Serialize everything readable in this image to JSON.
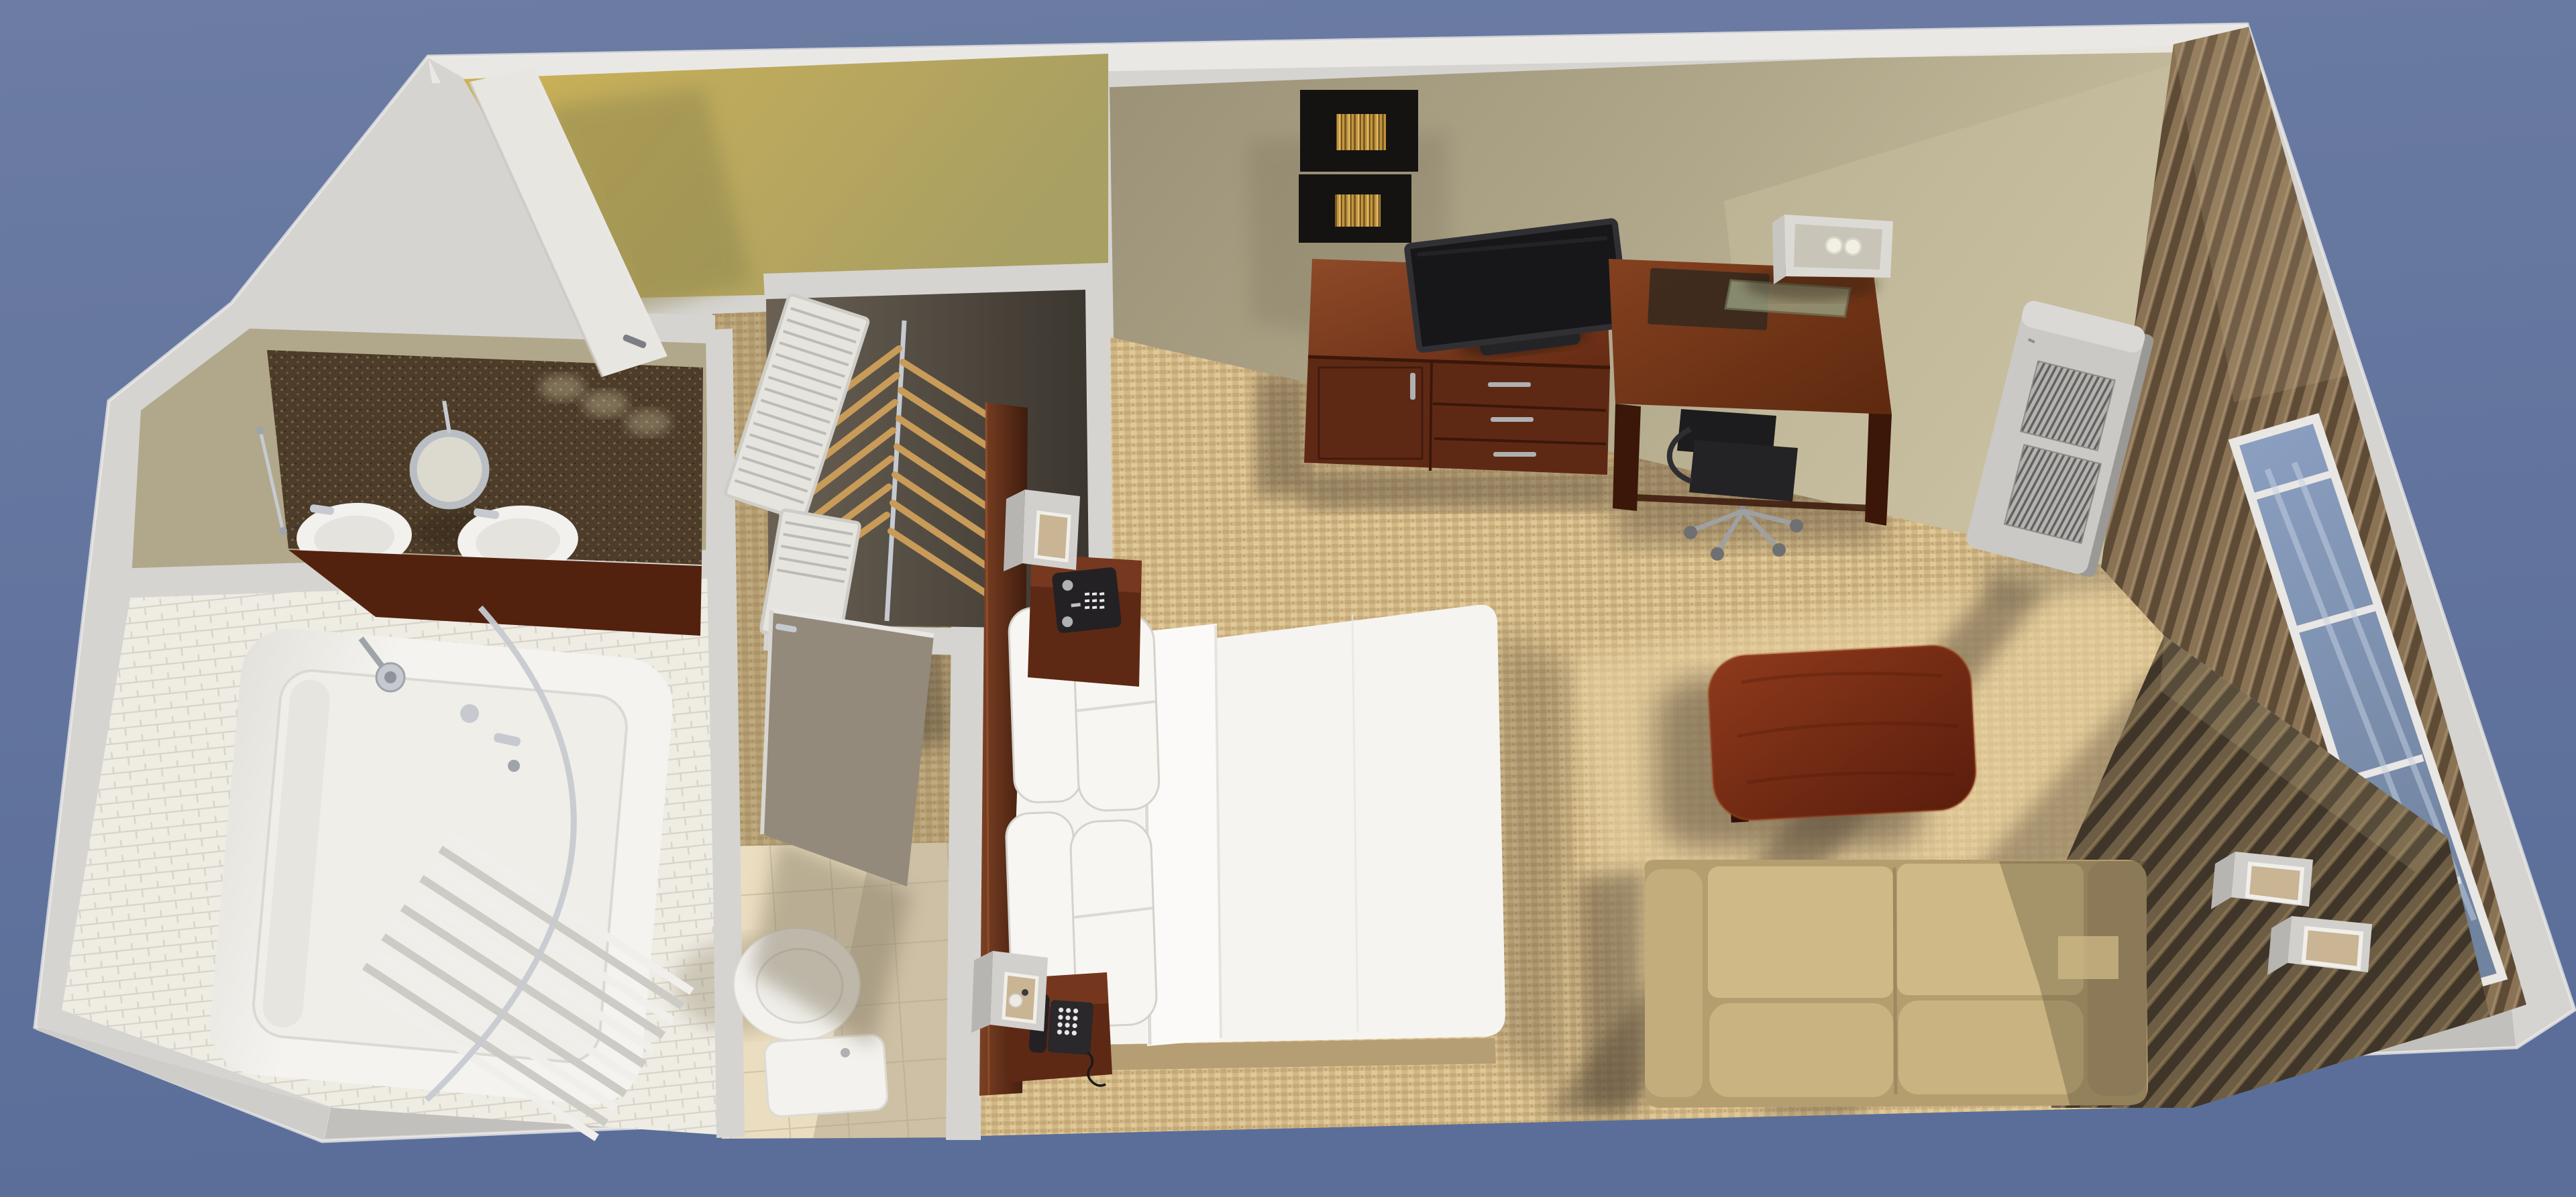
{
  "meta": {
    "title": "3D cutaway rendering of a hotel studio guest room, top-down view",
    "render_style": "photoreal 3D floor-plan cutaway",
    "visible_text": []
  },
  "colors": {
    "bg-top": "#6C7CA3",
    "bg-bottom": "#5A6E99",
    "wall-cap": "#D6D4D1",
    "wall-cap-bright": "#ECEAE7",
    "wall-band-dark": "#C2C0BD",
    "wall-face-lit": "#C9C0A1",
    "wall-face": "#B1A88B",
    "wall-face-dark": "#9A9177",
    "carpet-base": "#D3B885",
    "carpet-lit": "#E8D2A2",
    "carpet-speck-dark": "#B3986B",
    "carpet-speck-light": "#EFDFB2",
    "shadow-warm": "#5C4E3A",
    "entry-lit": "#CDB257",
    "entry-dark": "#A89F63",
    "vinyl-shadow": "#8F874F",
    "closet-dark": "#3B362F",
    "closet-light": "#6A6154",
    "hanger-wood": "#C89B59",
    "chrome": "#C6CAD0",
    "chrome-dark": "#9FA4AA",
    "louver": "#E6E4DF",
    "louver-slat": "#BDBBB6",
    "counter-dark": "#4C3C29",
    "counter-speck": "#7C6848",
    "sink-white": "#F2F1ED",
    "cabinet-wood": "#52220F",
    "mirror-ring": "#B9BEC4",
    "mirror-glass": "#DCD9CE",
    "tile-wall": "#EFECE4",
    "tile-grout": "#D8D4C9",
    "tub-white": "#F4F3EF",
    "tub-shade": "#DBD9D3",
    "curtain-light": "#F0EFEB",
    "curtain-shade": "#CDCBC6",
    "toilet-white": "#F3F2EE",
    "bathfloor": "#EADDC0",
    "bathfloor-grout": "#CFC4A8",
    "door-white": "#E8E6E1",
    "door-shadowed": "#938A7B",
    "wood-lit": "#8A4526",
    "wood-mid": "#5E2914",
    "wood-dark": "#3A1709",
    "cherry-lit": "#8E3A1C",
    "cherry-dark": "#5A1D0C",
    "bed-white": "#F6F4F0",
    "bed-fold": "#FBFAF8",
    "bed-crease": "#D5D2CC",
    "bed-base": "#B59E74",
    "pillow-white": "#F8F6F2",
    "tv-black": "#17171A",
    "tv-bezel": "#303034",
    "device-black": "#242124",
    "silver": "#AFB1B3",
    "sofa-base": "#B49E70",
    "sofa-back": "#CFBA87",
    "sofa-seat": "#C9B380",
    "sofa-arm": "#C3AD7C",
    "sofa-arm-dark": "#A8926A",
    "sconce-face": "#D2D0CC",
    "sconce-side": "#B7B5B1",
    "sconce-glow": "#C9B494",
    "sconce-rim": "#F0EFEA",
    "ac-body": "#CBC9C6",
    "ac-shade": "#9B9996",
    "ac-vent": "#636260",
    "ac-vent-bg": "#B5B3B0",
    "blind-light": "#8A7355",
    "blind-dark": "#5E4B36",
    "blind-hi": "#A0896A",
    "slat-light": "#6E5D45",
    "slat-dark": "#3F3528",
    "glass-blue": "#7E92B5",
    "glass-hi": "#C6D2E2",
    "frame-white": "#E9E7E4",
    "art-black": "#141311",
    "art-gold": "#C2953C",
    "art-gold-dark": "#7A5A24",
    "art-gold-hi": "#E0B968",
    "lamp-white": "#DCDAD5",
    "lamp-inner": "#C9C4B8",
    "bulb": "#F2EFE4",
    "glasspad": "#9AA183",
    "deskpad": "#3A2A1E"
  },
  "scene": {
    "rooms": [
      {
        "name": "entry-vestibule",
        "floor": "yellow vinyl",
        "items": [
          "entry-door-open"
        ]
      },
      {
        "name": "vanity-area",
        "items": [
          "granite-counter",
          "double-sinks",
          "magnifying-mirror",
          "towel-bar",
          "vanity-cabinet"
        ]
      },
      {
        "name": "shower-room",
        "floor": "white subway tile",
        "items": [
          "bathtub",
          "shower-curtain",
          "curved-curtain-rod",
          "showerhead",
          "tub-faucet"
        ]
      },
      {
        "name": "toilet-nook",
        "floor": "beige ceramic tile",
        "items": [
          "toilet",
          "bathroom-door-open"
        ]
      },
      {
        "name": "closet",
        "items": [
          "louvered-doors-open",
          "clothes-rod",
          "wooden-hangers"
        ]
      },
      {
        "name": "main-room",
        "floor": "beige loop carpet",
        "items": [
          "bed",
          "pillows",
          "headboard",
          "nightstand-with-clock",
          "nightstand-with-phone",
          "wall-sconces",
          "dresser",
          "flat-screen-tv",
          "wall-art-pair",
          "work-desk",
          "desk-lamp",
          "office-chair",
          "ptac-ac-unit",
          "coffee-table",
          "loveseat-sofa",
          "wood-slat-accent-wall",
          "cube-wall-lamps",
          "window-wall-with-blinds"
        ]
      }
    ],
    "objects": [
      {
        "name": "entry-door",
        "state": "open",
        "color": "door-white"
      },
      {
        "name": "bathroom-door",
        "state": "open",
        "color": "door-shadowed"
      },
      {
        "name": "louvered-closet-doors",
        "count": 2,
        "color": "louver"
      },
      {
        "name": "wooden-hangers",
        "count": 14,
        "color": "hanger-wood"
      },
      {
        "name": "double-sink-counter",
        "color": "counter-dark"
      },
      {
        "name": "round-magnifying-mirror",
        "color": "mirror-ring"
      },
      {
        "name": "bathtub",
        "color": "tub-white"
      },
      {
        "name": "shower-curtain",
        "color": "curtain-light"
      },
      {
        "name": "toilet",
        "color": "toilet-white"
      },
      {
        "name": "king-bed-white-bedding",
        "color": "bed-white"
      },
      {
        "name": "pillows",
        "count": 4,
        "color": "pillow-white"
      },
      {
        "name": "headboard",
        "color": "wood-mid"
      },
      {
        "name": "nightstand",
        "count": 2,
        "color": "wood-mid"
      },
      {
        "name": "alarm-clock-radio",
        "color": "device-black"
      },
      {
        "name": "telephone",
        "color": "device-black"
      },
      {
        "name": "bedside-sconce",
        "count": 2,
        "color": "sconce-face"
      },
      {
        "name": "dresser-credenza",
        "color": "wood-mid"
      },
      {
        "name": "flat-screen-tv",
        "color": "tv-black"
      },
      {
        "name": "framed-art",
        "count": 2,
        "color": "art-black"
      },
      {
        "name": "writing-desk",
        "color": "wood-mid"
      },
      {
        "name": "desk-lamp-open-shade",
        "color": "lamp-white"
      },
      {
        "name": "office-chair",
        "color": "device-black"
      },
      {
        "name": "ptac-air-conditioner",
        "color": "ac-body"
      },
      {
        "name": "coffee-table",
        "color": "cherry-lit"
      },
      {
        "name": "loveseat",
        "color": "sofa-base"
      },
      {
        "name": "cube-wall-lamp",
        "count": 2,
        "color": "sconce-face"
      },
      {
        "name": "vertical-wood-blinds",
        "color": "blind-light"
      },
      {
        "name": "slat-accent-wall",
        "color": "slat-light"
      },
      {
        "name": "window-glass",
        "color": "glass-blue"
      }
    ]
  }
}
